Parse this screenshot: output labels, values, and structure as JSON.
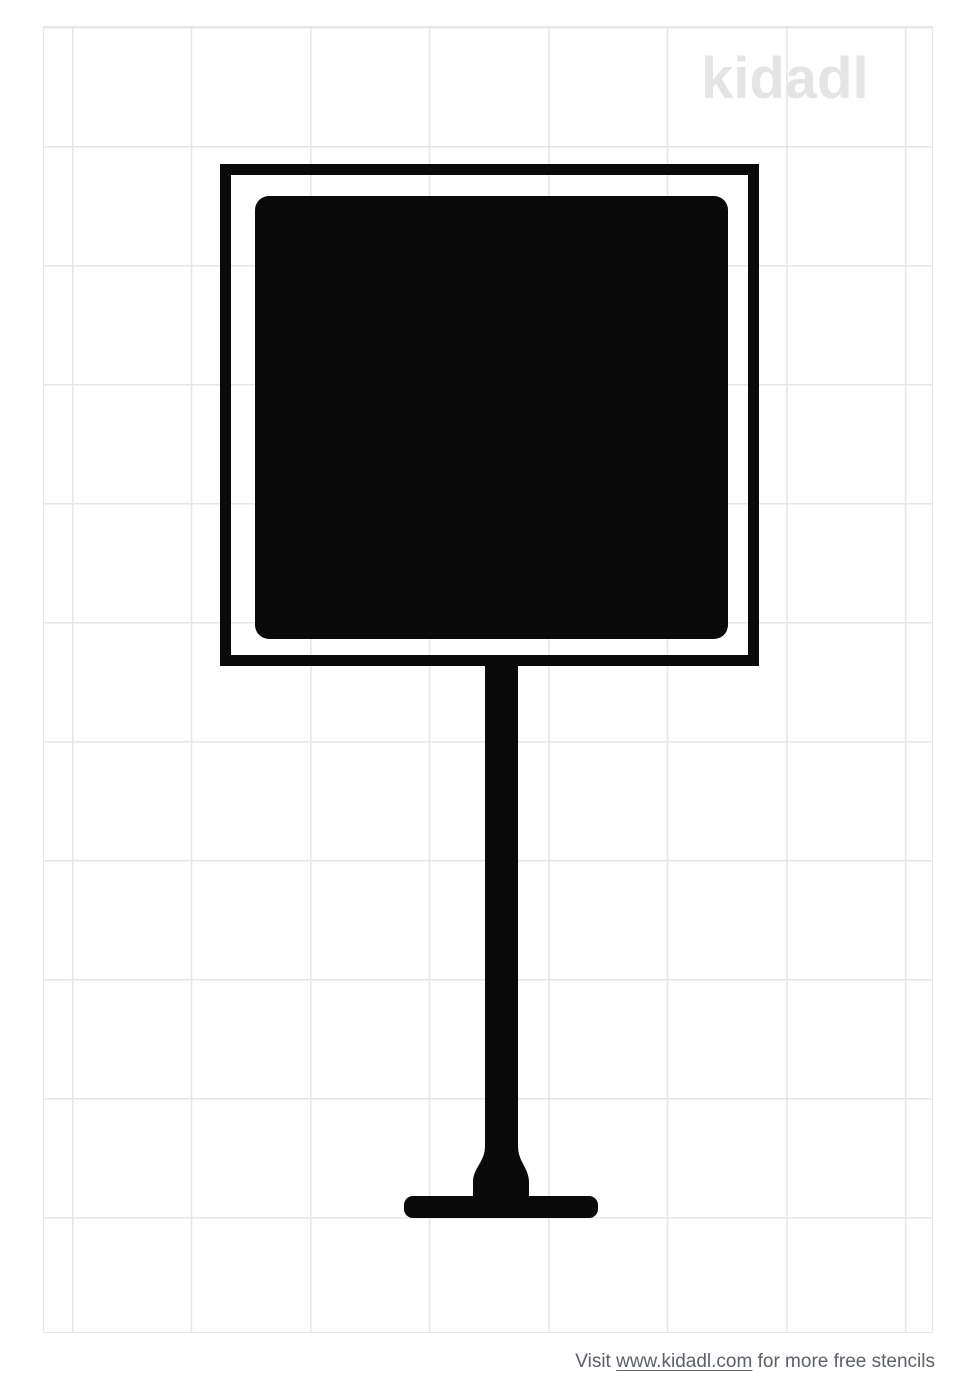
{
  "watermark": {
    "text": "kidadl",
    "color": "#e3e4e5"
  },
  "grid": {
    "line_color": "#e4e6e8"
  },
  "stencil": {
    "label": "square sign on post stencil",
    "color": "#0a0a0a"
  },
  "footer": {
    "prefix": "Visit ",
    "link_text": "www.kidadl.com",
    "suffix": " for more free stencils",
    "text_color": "#5c6167"
  }
}
